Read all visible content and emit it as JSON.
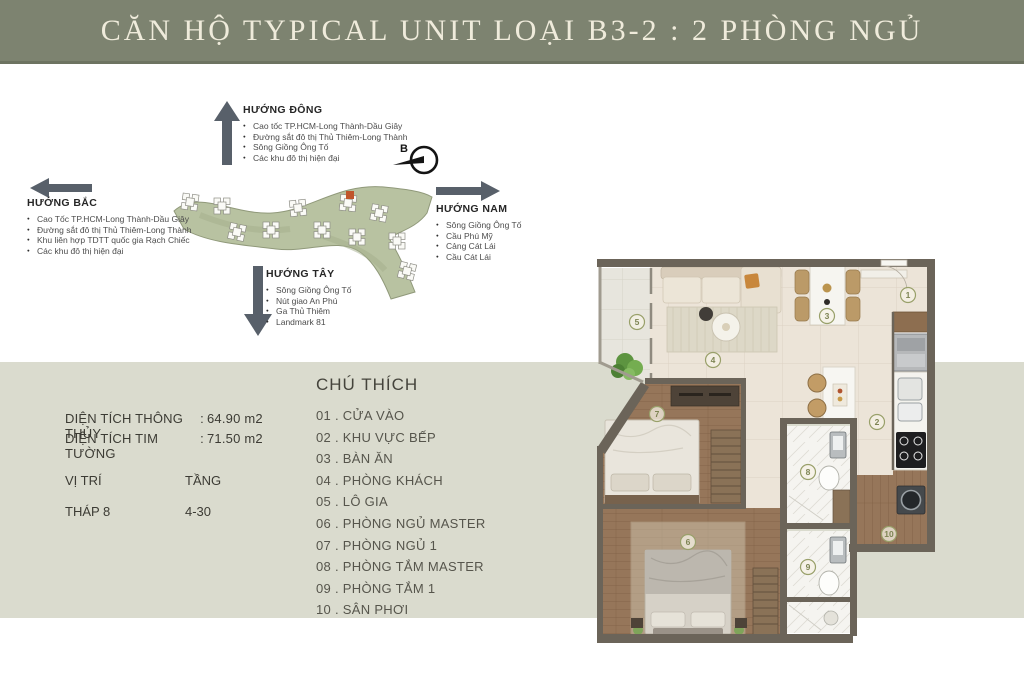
{
  "banner": {
    "title": "CĂN HỘ TYPICAL UNIT LOẠI  B3-2 : 2 PHÒNG NGỦ"
  },
  "directions": {
    "east": {
      "label": "HƯỚNG ĐÔNG",
      "items": [
        "Cao tốc TP.HCM-Long Thành-Dầu Giây",
        "Đường sắt đô thị Thủ Thiêm-Long Thành",
        "Sông Giồng Ông Tố",
        "Các khu đô thị hiện đại"
      ]
    },
    "north": {
      "label": "HƯỚNG BẮC",
      "items": [
        "Cao Tốc TP.HCM-Long Thành-Dầu Giây",
        "Đường sắt đô thị Thủ Thiêm-Long Thành",
        "Khu liên hợp TDTT quốc gia Rạch Chiếc",
        "Các khu đô thị hiện đại"
      ]
    },
    "south": {
      "label": "HƯỚNG NAM",
      "items": [
        "Sông Giồng Ông Tố",
        "Cầu Phú Mỹ",
        "Cảng Cát Lái",
        "Cầu Cát Lái"
      ]
    },
    "west": {
      "label": "HƯỚNG TÂY",
      "items": [
        "Sông Giồng Ông Tố",
        "Nút giao An Phú",
        "Ga Thủ Thiêm",
        "Landmark 81"
      ]
    }
  },
  "north_marker": {
    "label": "B"
  },
  "info": {
    "rows": [
      {
        "label": "DIỆN TÍCH THÔNG THỦY",
        "colon": ":",
        "value": "64.90 m2"
      },
      {
        "label": "DIỆN TÍCH TIM TƯỜNG",
        "colon": ":",
        "value": "71.50 m2"
      }
    ],
    "position_label": "VỊ TRÍ",
    "floor_label": "TẦNG",
    "position_value": "THÁP 8",
    "floor_value": "4-30"
  },
  "legend": {
    "title": "CHÚ THÍCH",
    "items": [
      "01 . CỬA VÀO",
      "02 . KHU VỰC BẾP",
      "03 . BÀN ĂN",
      "04 . PHÒNG KHÁCH",
      "05 . LÔ GIA",
      "06 . PHÒNG NGỦ MASTER",
      "07 . PHÒNG NGỦ 1",
      "08 . PHÒNG TẮM MASTER",
      "09 . PHÒNG TẮM 1",
      "10 . SÂN PHƠI"
    ]
  },
  "plan": {
    "markers": [
      "1",
      "2",
      "3",
      "4",
      "5",
      "6",
      "7",
      "8",
      "9",
      "10"
    ]
  },
  "colors": {
    "banner_bg": "#7d8370",
    "band_bg": "#dadbce",
    "arrow": "#58606a",
    "map_green": "#b8c2a1",
    "map_highlight": "#c0552b",
    "wall": "#6b6459",
    "wood_floor": "#96765a",
    "tile_floor": "#ece4d8",
    "marker_olive": "#99a06a"
  }
}
